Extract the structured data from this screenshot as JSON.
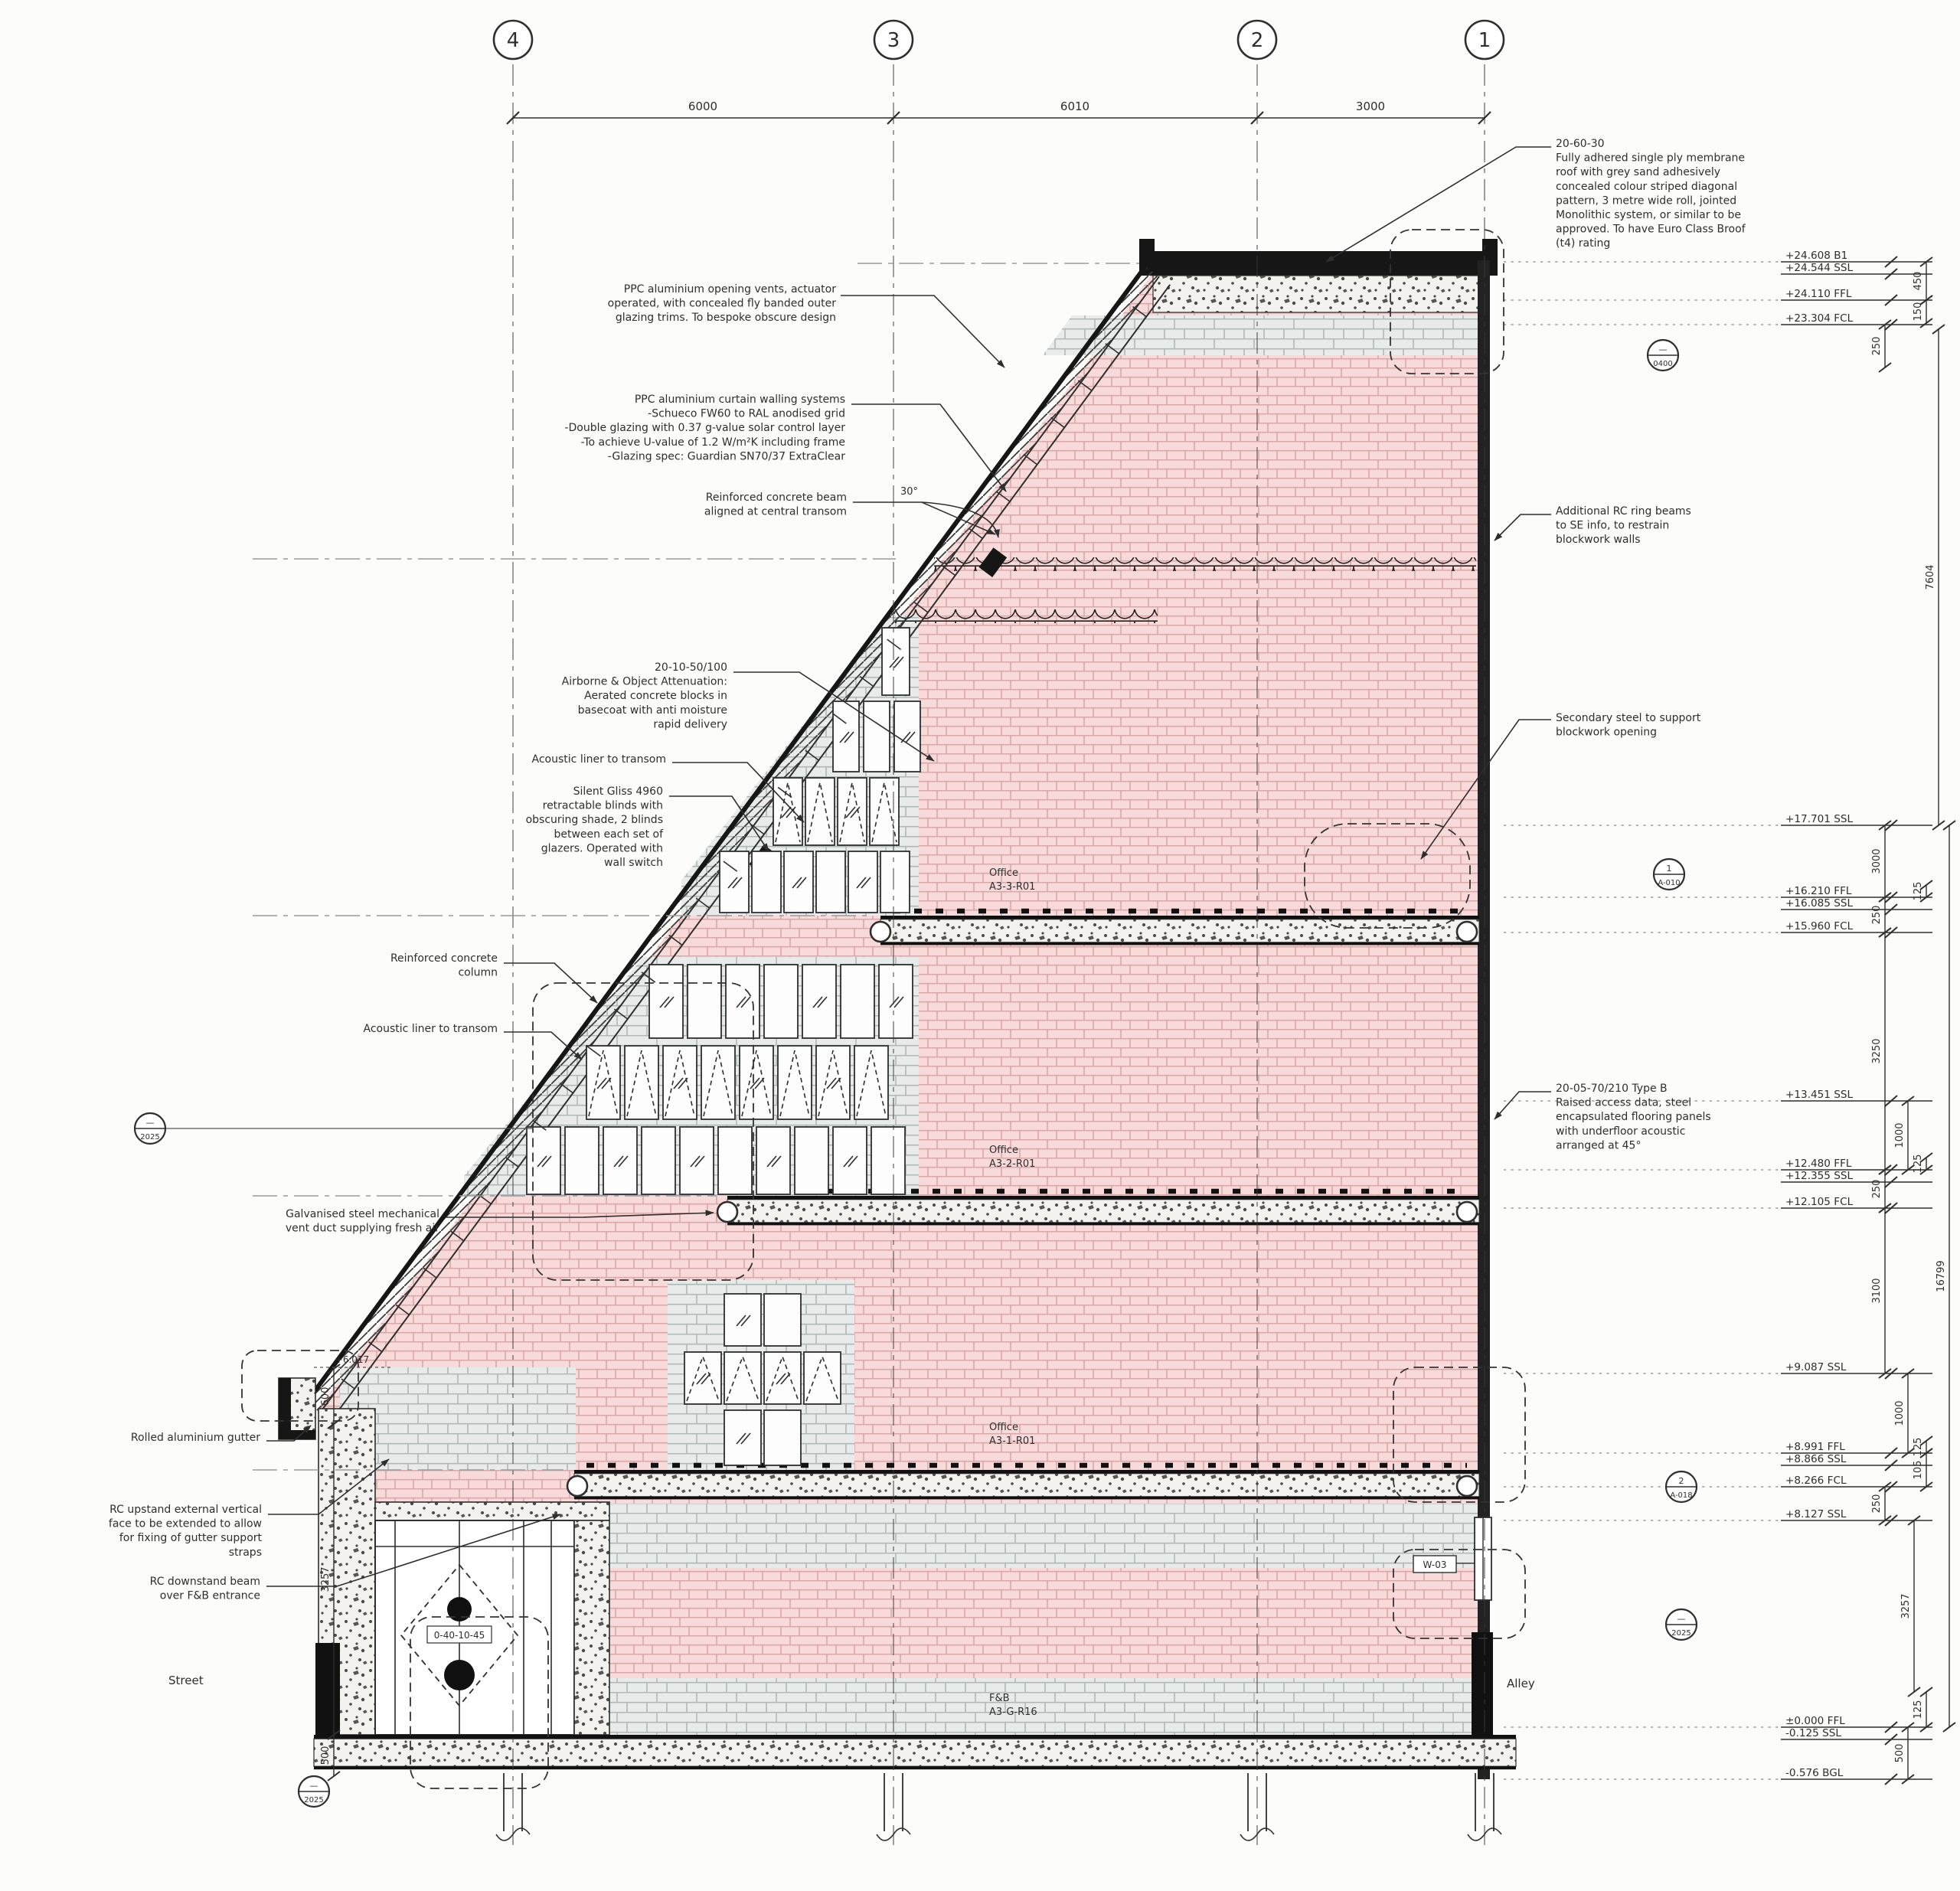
{
  "grid_bubbles": [
    "4",
    "3",
    "2",
    "1"
  ],
  "grid_dims": [
    "6000",
    "6010",
    "3000"
  ],
  "angle_label": "30°",
  "street_label": "Street",
  "alley_label": "Alley",
  "gutter_level": "+6.017",
  "door_tag": "W-03",
  "entrance_tag": "0-40-10-45",
  "rooms": [
    {
      "name": "Office",
      "ref": "A3-3-R01"
    },
    {
      "name": "Office",
      "ref": "A3-2-R01"
    },
    {
      "name": "Office",
      "ref": "A3-1-R01"
    },
    {
      "name": "F&B",
      "ref": "A3-G-R16"
    }
  ],
  "notes_left": [
    {
      "lines": [
        "PPC aluminium opening vents, actuator",
        "operated, with concealed fly banded outer",
        "glazing trims. To bespoke obscure design"
      ]
    },
    {
      "lines": [
        "PPC aluminium curtain walling systems",
        "-Schueco FW60 to RAL anodised grid",
        "-Double glazing with 0.37 g-value solar control layer",
        "-To achieve U-value of 1.2 W/m²K including frame",
        "-Glazing spec: Guardian SN70/37 ExtraClear"
      ]
    },
    {
      "lines": [
        "Reinforced concrete beam",
        "aligned at central transom"
      ]
    },
    {
      "lines": [
        "20-10-50/100",
        "Airborne & Object Attenuation:",
        "Aerated concrete blocks in",
        "basecoat with anti moisture",
        "rapid delivery"
      ]
    },
    {
      "lines": [
        "Acoustic liner to transom"
      ]
    },
    {
      "lines": [
        "Silent Gliss 4960",
        "retractable blinds with",
        "obscuring shade, 2 blinds",
        "between each set of",
        "glazers. Operated with",
        "wall switch"
      ]
    },
    {
      "lines": [
        "Reinforced concrete",
        "column"
      ]
    },
    {
      "lines": [
        "Acoustic liner to transom"
      ]
    },
    {
      "lines": [
        "Galvanised steel mechanical",
        "vent duct supplying fresh air"
      ]
    },
    {
      "lines": [
        "Rolled aluminium gutter"
      ]
    },
    {
      "lines": [
        "RC upstand external vertical",
        "face to be extended to allow",
        "for fixing of gutter support",
        "straps"
      ]
    },
    {
      "lines": [
        "RC downstand beam",
        "over F&B entrance"
      ]
    }
  ],
  "notes_right": [
    {
      "lines": [
        "20-60-30",
        "Fully adhered single ply membrane",
        "roof with grey sand adhesively",
        "concealed colour striped diagonal",
        "pattern, 3 metre wide roll, jointed",
        "Monolithic system, or similar to be",
        "approved. To have Euro Class Broof",
        "(t4) rating"
      ]
    },
    {
      "lines": [
        "Additional RC ring beams",
        "to SE info, to restrain",
        "blockwork walls"
      ]
    },
    {
      "lines": [
        "Secondary steel to support",
        "blockwork opening"
      ]
    },
    {
      "lines": [
        "20-05-70/210 Type B",
        "Raised access data, steel",
        "encapsulated flooring panels",
        "with underfloor acoustic",
        "arranged at 45°"
      ]
    }
  ],
  "levels": [
    {
      "label": "+24.608 B1"
    },
    {
      "label": "+24.544 SSL"
    },
    {
      "label": "+24.110 FFL"
    },
    {
      "label": "+23.304 FCL"
    },
    {
      "label": "+17.701 SSL"
    },
    {
      "label": "+16.210 FFL"
    },
    {
      "label": "+16.085 SSL"
    },
    {
      "label": "+15.960 FCL"
    },
    {
      "label": "+13.451 SSL"
    },
    {
      "label": "+12.480 FFL"
    },
    {
      "label": "+12.355 SSL"
    },
    {
      "label": "+12.105 FCL"
    },
    {
      "label": "+9.087 SSL"
    },
    {
      "label": "+8.991 FFL"
    },
    {
      "label": "+8.866 SSL"
    },
    {
      "label": "+8.266 FCL"
    },
    {
      "label": "+8.127 SSL"
    },
    {
      "label": "±0.000 FFL"
    },
    {
      "label": "-0.125 SSL"
    },
    {
      "label": "-0.576 BGL"
    }
  ],
  "vdims_right": [
    "450",
    "150",
    "250",
    "7604",
    "3000",
    "125",
    "250",
    "3250",
    "1000",
    "125",
    "250",
    "3100",
    "1000",
    "125",
    "105",
    "250",
    "3257",
    "125",
    "500",
    "16799"
  ],
  "vdims_left": [
    "600",
    "3257",
    "500"
  ],
  "ref_markers": [
    {
      "top": "—",
      "bottom": "2025"
    },
    {
      "top": "—",
      "bottom": "2025"
    },
    {
      "top": "—",
      "bottom": "0400"
    },
    {
      "top": "1",
      "bottom": "A-010"
    },
    {
      "top": "2",
      "bottom": "A-018"
    },
    {
      "top": "—",
      "bottom": "2025"
    }
  ],
  "colors": {
    "line": "#2e2e2e",
    "brick": "#f8dada",
    "mortar": "#d9a8a8",
    "block": "#e8ebea",
    "joint": "#b0b8b7",
    "speckle_bg": "#f3f2ee",
    "ink": "#161616"
  }
}
